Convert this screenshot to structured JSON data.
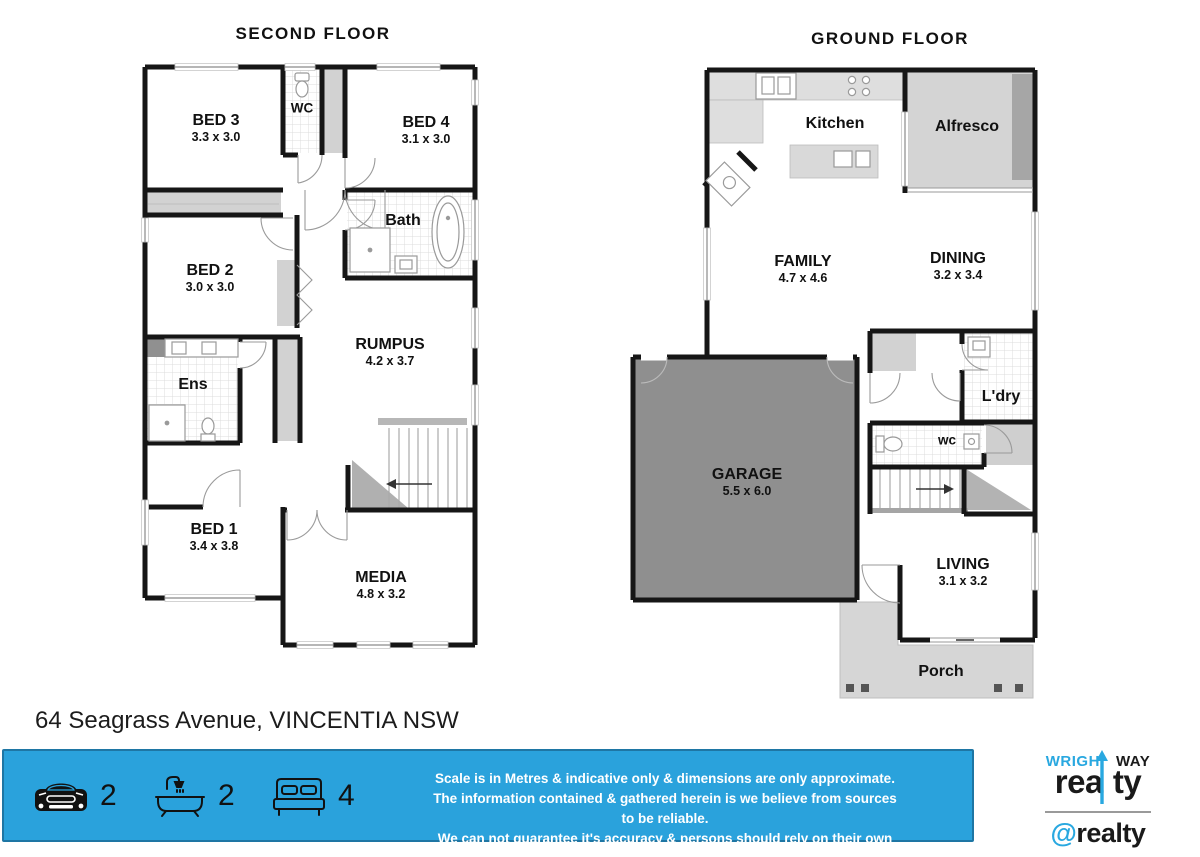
{
  "titles": {
    "second_floor": "SECOND FLOOR",
    "ground_floor": "GROUND FLOOR"
  },
  "address": "64 Seagrass Avenue, VINCENTIA NSW",
  "second_floor": {
    "rooms": [
      {
        "name": "BED 3",
        "dims": "3.3 x 3.0"
      },
      {
        "name": "WC",
        "dims": ""
      },
      {
        "name": "BED 4",
        "dims": "3.1 x 3.0"
      },
      {
        "name": "Bath",
        "dims": ""
      },
      {
        "name": "BED 2",
        "dims": "3.0 x 3.0"
      },
      {
        "name": "Ens",
        "dims": ""
      },
      {
        "name": "RUMPUS",
        "dims": "4.2 x 3.7"
      },
      {
        "name": "BED 1",
        "dims": "3.4 x 3.8"
      },
      {
        "name": "MEDIA",
        "dims": "4.8 x 3.2"
      }
    ]
  },
  "ground_floor": {
    "rooms": [
      {
        "name": "Kitchen",
        "dims": ""
      },
      {
        "name": "Alfresco",
        "dims": ""
      },
      {
        "name": "FAMILY",
        "dims": "4.7 x 4.6"
      },
      {
        "name": "DINING",
        "dims": "3.2 x 3.4"
      },
      {
        "name": "GARAGE",
        "dims": "5.5 x 6.0"
      },
      {
        "name": "L'dry",
        "dims": ""
      },
      {
        "name": "wc",
        "dims": ""
      },
      {
        "name": "LIVING",
        "dims": "3.1 x 3.2"
      },
      {
        "name": "Porch",
        "dims": ""
      }
    ]
  },
  "footer": {
    "stats": [
      {
        "icon": "car-icon",
        "value": "2"
      },
      {
        "icon": "bath-icon",
        "value": "2"
      },
      {
        "icon": "bed-icon",
        "value": "4"
      }
    ],
    "disclaimer_lines": [
      "Scale is in Metres & indicative only & dimensions are only approximate.",
      "The information contained & gathered herein is we believe from sources to be reliable.",
      "We can not guarantee it's accuracy & persons should rely on their own enquiries."
    ]
  },
  "branding": {
    "wrightway": {
      "part1": "WRIGH",
      "part2": "WAY",
      "part3": "rea",
      "part4": "ty"
    },
    "atrealty": {
      "at": "@",
      "name": "realty"
    }
  },
  "colors": {
    "footer_bg": "#2AA2DC",
    "footer_border": "#1E76A4",
    "brand_blue": "#29A8E0",
    "garage_fill": "#8F8F8F",
    "wall": "#161616"
  }
}
